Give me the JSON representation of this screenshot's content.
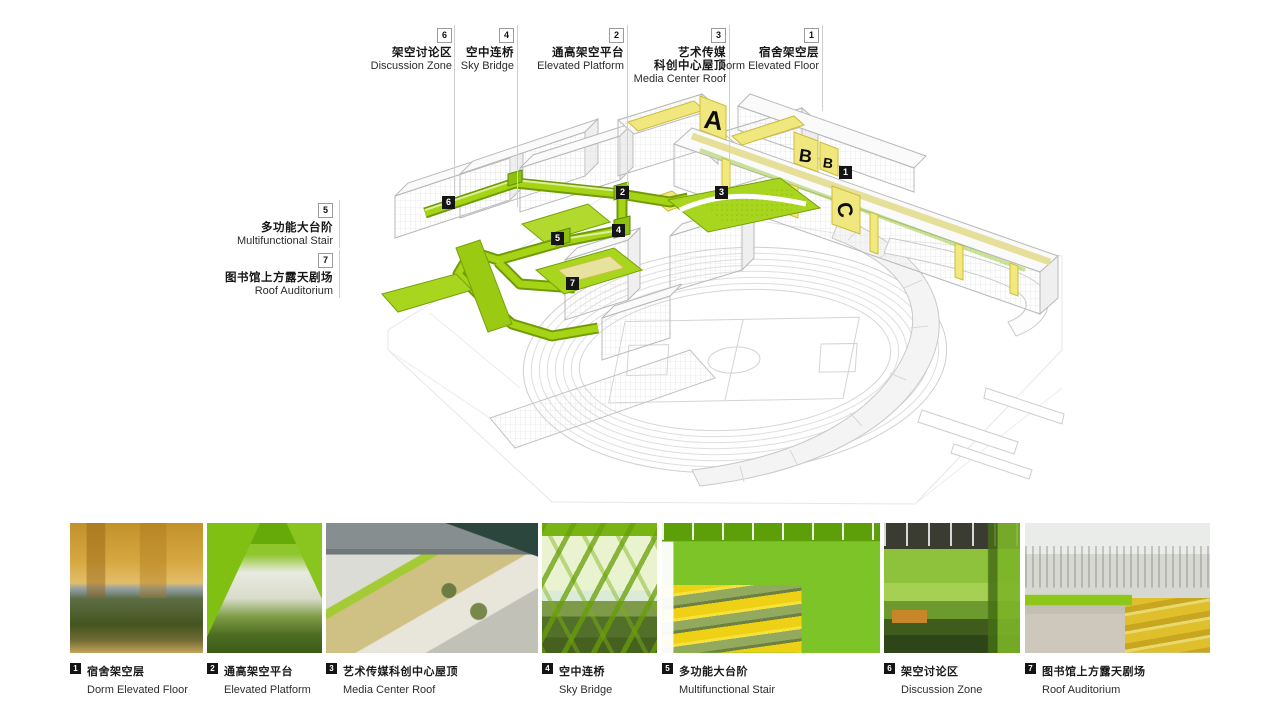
{
  "diagram": {
    "callouts_top": [
      {
        "num": "6",
        "zh": "架空讨论区",
        "en": "Discussion Zone"
      },
      {
        "num": "4",
        "zh": "空中连桥",
        "en": "Sky Bridge"
      },
      {
        "num": "2",
        "zh": "通高架空平台",
        "en": "Elevated Platform"
      },
      {
        "num": "3",
        "zh": "艺术传媒",
        "zh2": "科创中心屋顶",
        "en": "Media Center Roof"
      },
      {
        "num": "1",
        "zh": "宿舍架空层",
        "en": "Dorm Elevated Floor"
      }
    ],
    "callouts_left": [
      {
        "num": "5",
        "zh": "多功能大台阶",
        "en": "Multifunctional Stair"
      },
      {
        "num": "7",
        "zh": "图书馆上方露天剧场",
        "en": "Roof Auditorium"
      }
    ],
    "markers": [
      {
        "num": "1"
      },
      {
        "num": "2"
      },
      {
        "num": "3"
      },
      {
        "num": "4"
      },
      {
        "num": "5"
      },
      {
        "num": "6"
      },
      {
        "num": "7"
      }
    ],
    "building_letters": [
      "A",
      "B",
      "B",
      "C"
    ],
    "colors": {
      "highlight_green": "#a6d414",
      "highlight_green_dark": "#76a008",
      "highlight_yellow": "#f0e87e",
      "linework_gray": "#c6c6c6",
      "marker_black": "#151515"
    }
  },
  "gallery": [
    {
      "num": "1",
      "zh": "宿舍架空层",
      "en": "Dorm Elevated Floor"
    },
    {
      "num": "2",
      "zh": "通高架空平台",
      "en": "Elevated Platform"
    },
    {
      "num": "3",
      "zh": "艺术传媒科创中心屋顶",
      "en": "Media Center Roof"
    },
    {
      "num": "4",
      "zh": "空中连桥",
      "en": "Sky Bridge"
    },
    {
      "num": "5",
      "zh": "多功能大台阶",
      "en": "Multifunctional Stair"
    },
    {
      "num": "6",
      "zh": "架空讨论区",
      "en": "Discussion Zone"
    },
    {
      "num": "7",
      "zh": "图书馆上方露天剧场",
      "en": "Roof Auditorium"
    }
  ]
}
